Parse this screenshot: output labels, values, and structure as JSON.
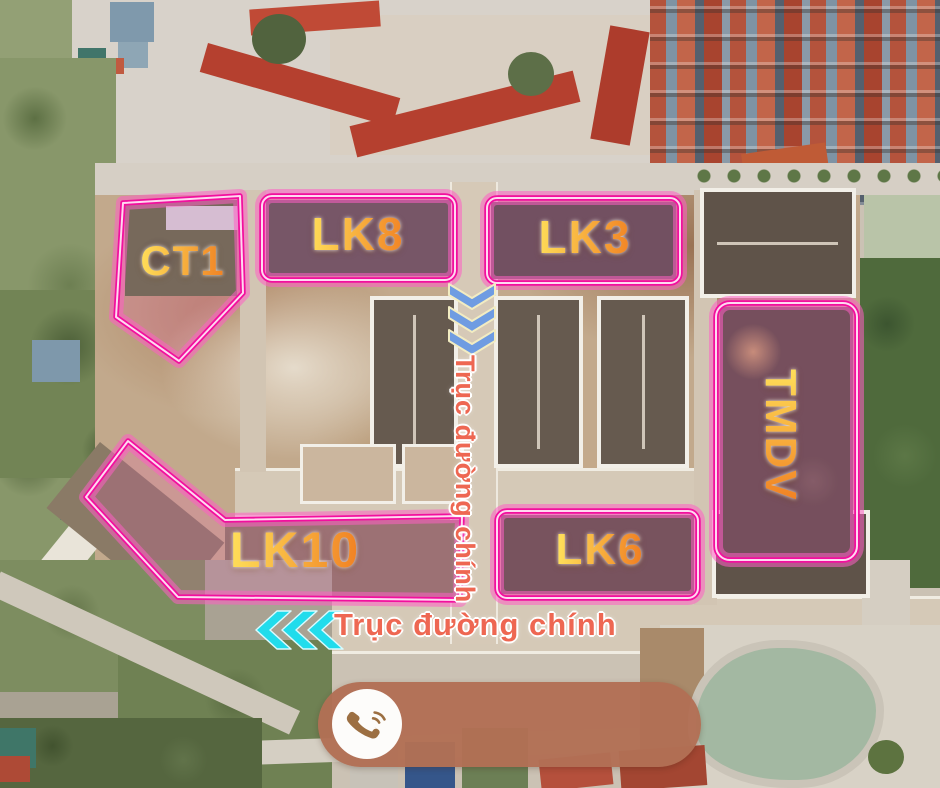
{
  "title": "Real-estate project aerial master plan",
  "zones": [
    {
      "id": "ct1",
      "label": "CT1"
    },
    {
      "id": "lk8",
      "label": "LK8"
    },
    {
      "id": "lk3",
      "label": "LK3"
    },
    {
      "id": "tmdv",
      "label": "TMDV"
    },
    {
      "id": "lk10",
      "label": "LK10"
    },
    {
      "id": "lk6",
      "label": "LK6"
    }
  ],
  "road_labels": {
    "vertical": "Trục đường chính",
    "horizontal": "Trục đường chính"
  },
  "direction_markers": [
    {
      "id": "main-axis-down",
      "icon": "chevron-down-icon",
      "count": 3,
      "color": "#6f9ce2"
    },
    {
      "id": "main-axis-left",
      "icon": "chevron-left-icon",
      "count": 3,
      "color": "#21dcec"
    }
  ],
  "contact": {
    "icon": "phone-icon",
    "pill_color": "#b26f55"
  },
  "colors": {
    "zone_outline": "#f20f9e",
    "zone_glow": "#ff5fc4",
    "zone_inner_line": "#ffd9f0",
    "label_gradient_start": "#ffe05a",
    "label_gradient_end": "#f07f22",
    "road_label": "#ee6752",
    "pond": "#a3b8a2"
  }
}
